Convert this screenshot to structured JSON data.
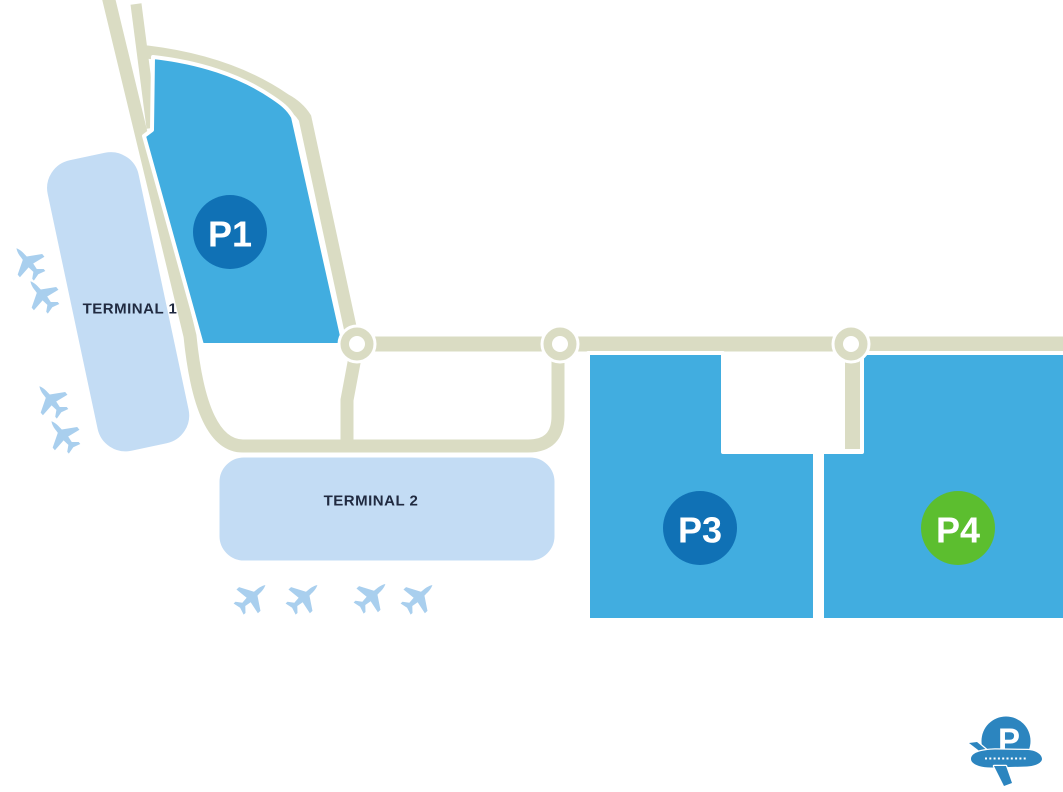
{
  "terminals": [
    {
      "id": "terminal-1",
      "label": "TERMINAL 1"
    },
    {
      "id": "terminal-2",
      "label": "TERMINAL 2"
    }
  ],
  "parking_zones": [
    {
      "id": "p1",
      "label": "P1",
      "badge_color": "#1071B5",
      "area_color": "#41ADE0"
    },
    {
      "id": "p3",
      "label": "P3",
      "badge_color": "#1071B5",
      "area_color": "#41ADE0"
    },
    {
      "id": "p4",
      "label": "P4",
      "badge_color": "#5CBE2F",
      "area_color": "#41ADE0"
    }
  ],
  "logo": {
    "letter": "P",
    "color": "#2C85BF"
  },
  "colors": {
    "background": "#FFFFFF",
    "road": "#DADCC3",
    "terminal_fill": "#C3DCF4",
    "airplane": "#A9CFEE",
    "label_text": "#202A40",
    "badge_text": "#FFFFFF"
  },
  "icons": {
    "airplane": "airplane-silhouette",
    "logo_mark": "circle-P-with-airplane"
  }
}
